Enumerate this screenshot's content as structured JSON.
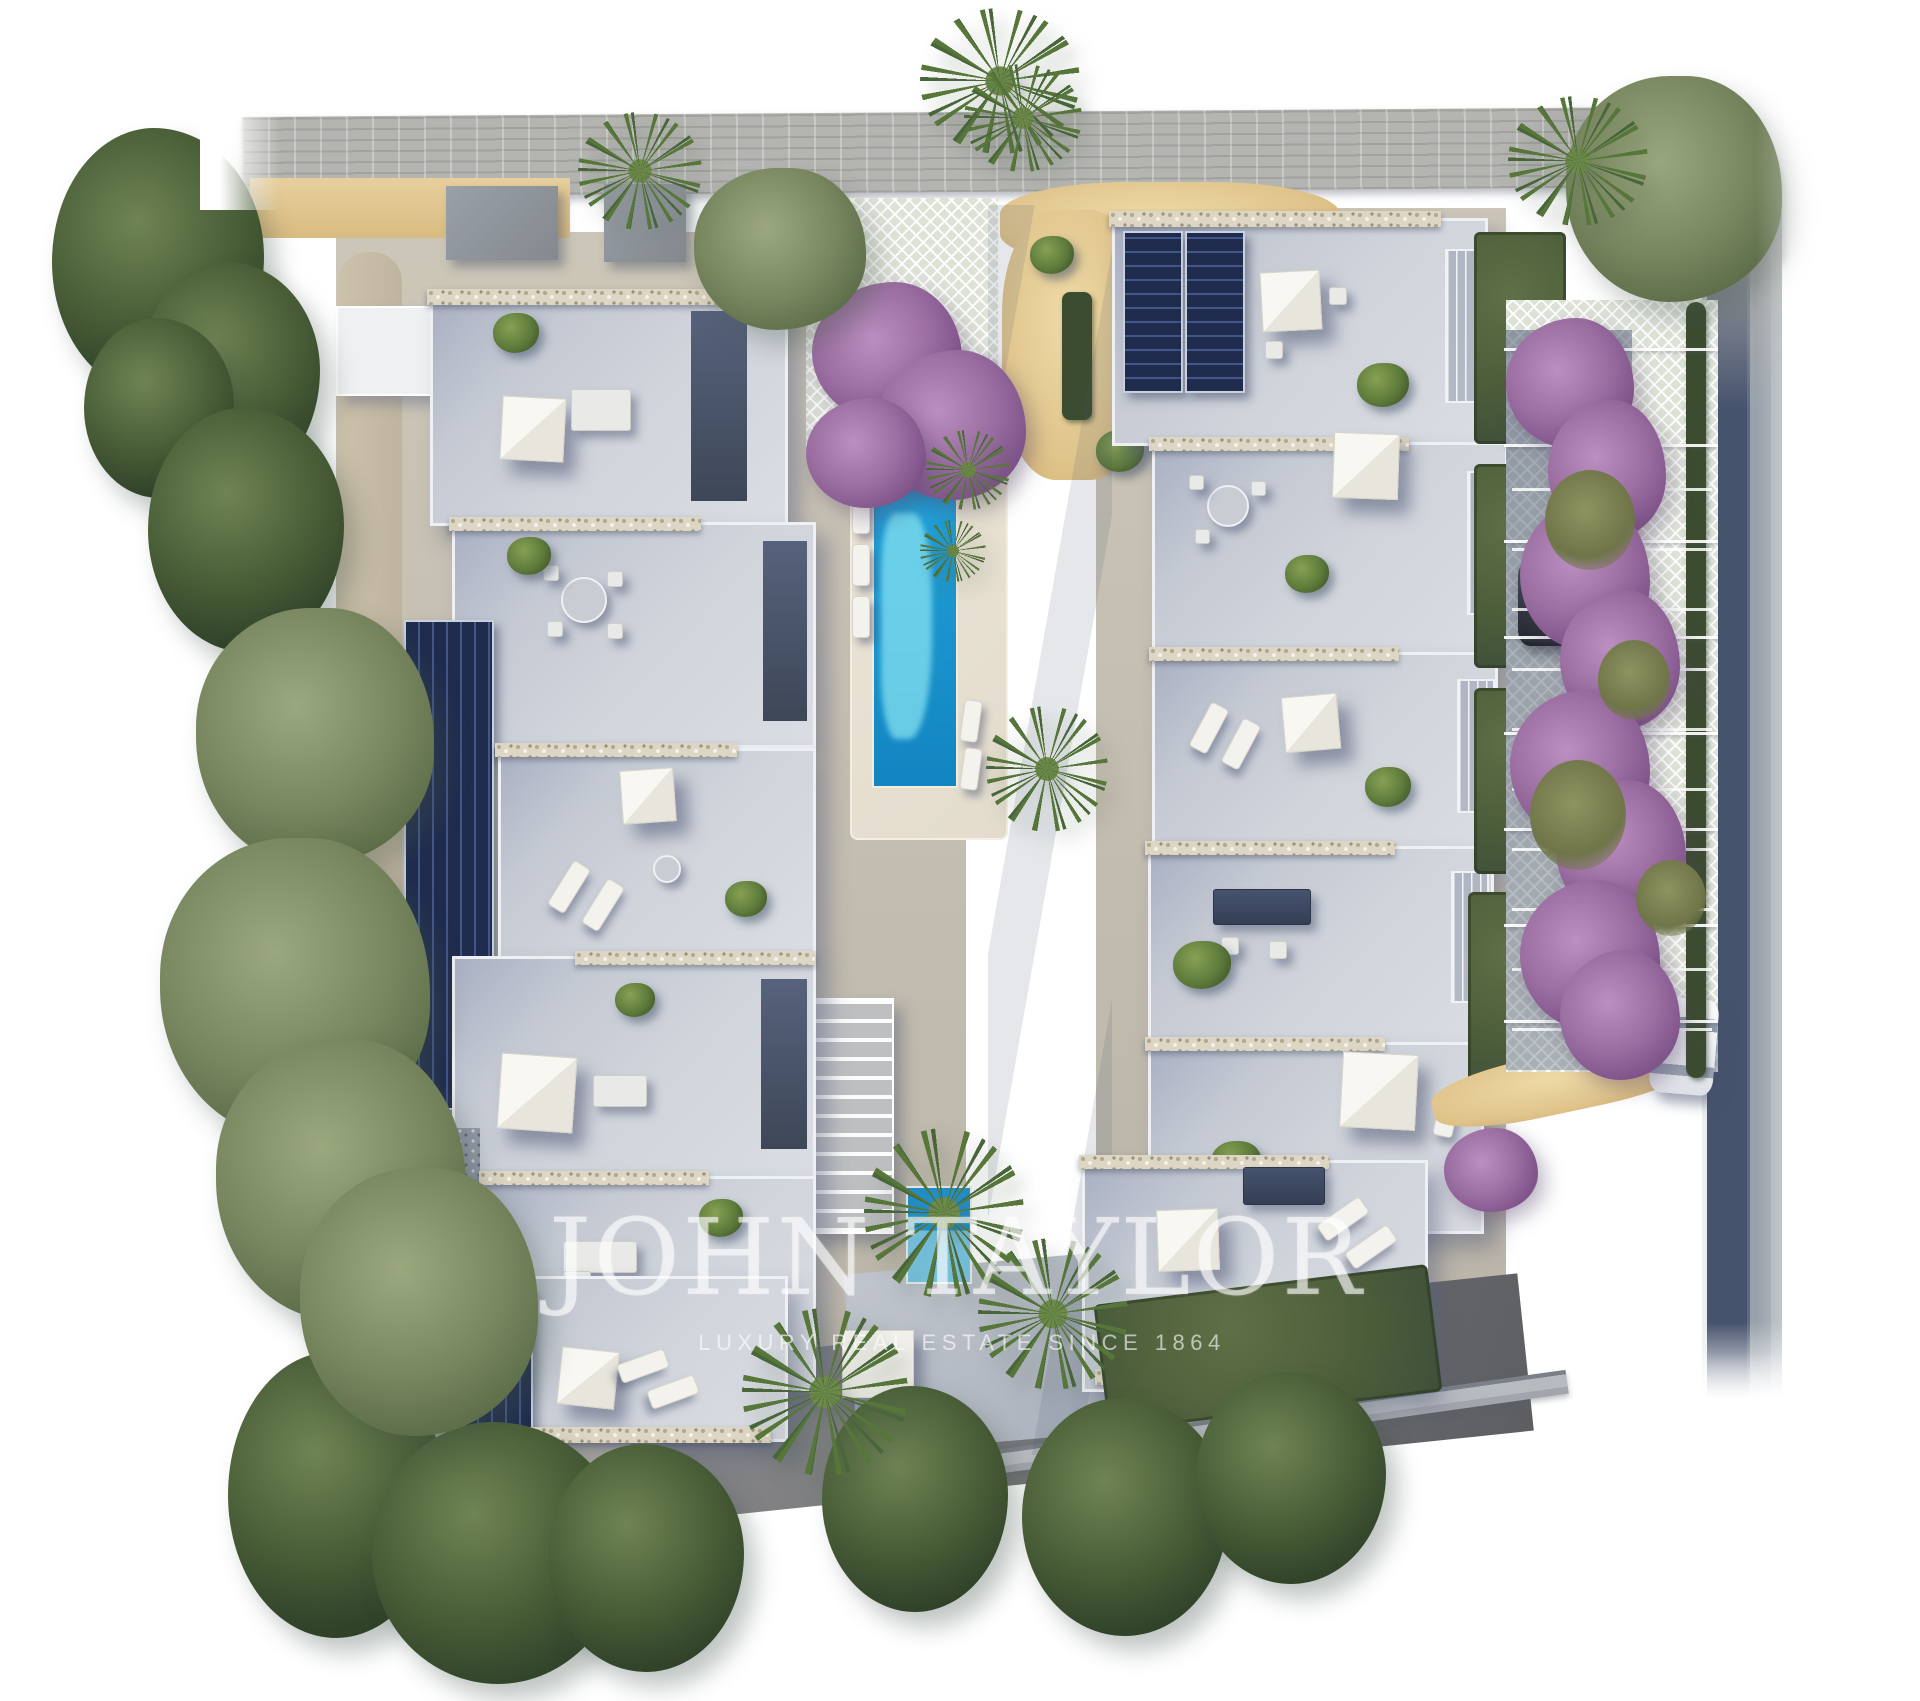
{
  "image": {
    "type": "aerial-3d-render",
    "description": "Top-down architectural render of a modern white-villa residential development with communal lap pool, roof terraces with solar panels, bougainvillea-covered parking pergola, lawns, palms and pine trees",
    "watermark": {
      "title": "JOHN TAYLOR",
      "subtitle": "LUXURY REAL ESTATE SINCE 1864"
    },
    "palette": {
      "background": "#ffffff",
      "road_top": "#b4b4b1",
      "road_right_dark": "#46536d",
      "sidewalk_gray": "#b7babf",
      "roof_terrace": "#d0d4db",
      "roof_shadow": "#8f97ab",
      "parapet_white": "#eff0f3",
      "gabion_stone": "#ddd6c5",
      "solar_panel_navy": "#1f2c4e",
      "pool_deep_blue": "#1285c1",
      "pool_shallow_turquoise": "#84e2f0",
      "deck_beige": "#e8e1d3",
      "sand_path": "#e0c58c",
      "lawn_green": "#4c5d3a",
      "pine_green": "#32442a",
      "olive_green": "#78865f",
      "palm_green": "#57763a",
      "bougainvillea_purple": "#9c6fa2",
      "pergola_lattice": "#dde2d7",
      "car_white": "#fbfbfc",
      "car_dark": "#22262d"
    }
  }
}
